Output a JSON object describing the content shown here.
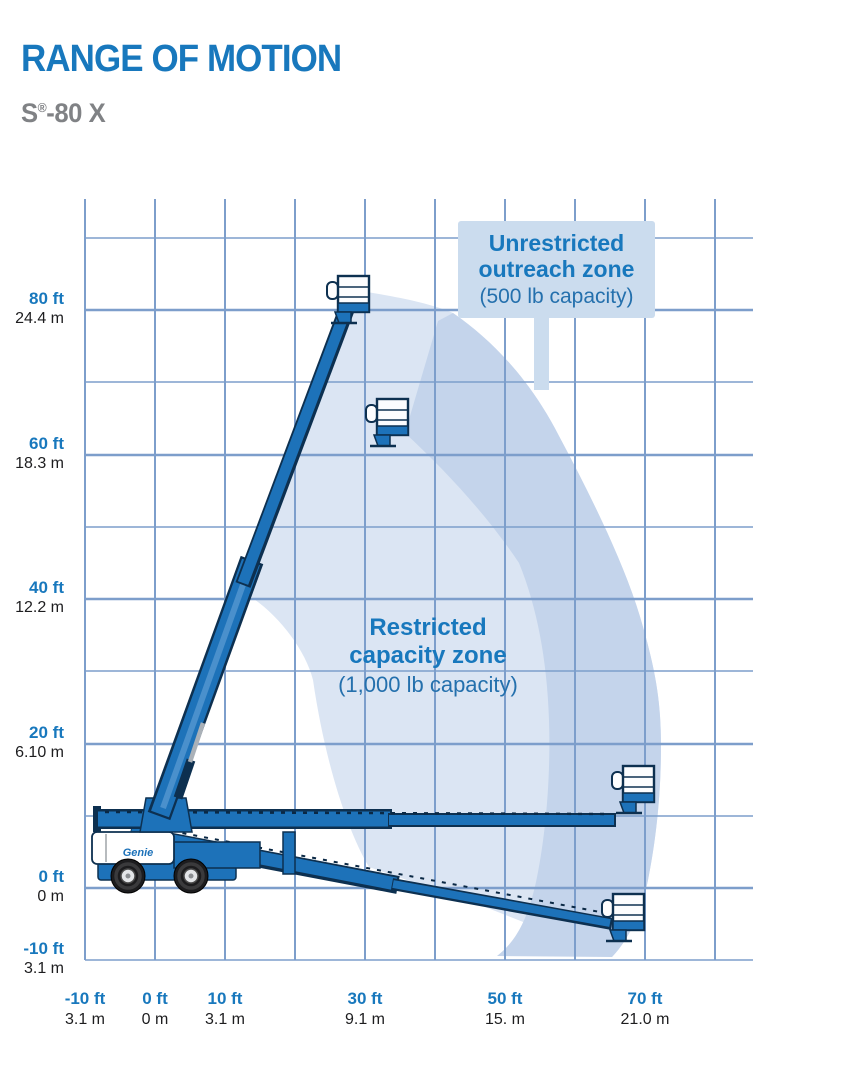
{
  "header": {
    "title": "RANGE OF MOTION",
    "model_prefix": "S",
    "model_reg": "®",
    "model_suffix": "-80 X"
  },
  "colors": {
    "brand_blue": "#1878bd",
    "machine_blue": "#1d72b9",
    "outline_navy": "#0d3050",
    "grid_blue": "#7d9ecb",
    "restricted_zone_fill": "#dbe5f3",
    "unrestricted_zone_fill": "#c4d4eb",
    "label_box_fill": "#cbdcee",
    "model_gray": "#808285"
  },
  "chart": {
    "y_ticks": [
      {
        "ft": "80 ft",
        "m": "24.4 m",
        "y": 310
      },
      {
        "ft": "60 ft",
        "m": "18.3 m",
        "y": 455
      },
      {
        "ft": "40 ft",
        "m": "12.2 m",
        "y": 599
      },
      {
        "ft": "20 ft",
        "m": "6.10 m",
        "y": 744
      },
      {
        "ft": "0 ft",
        "m": "0 m",
        "y": 888
      },
      {
        "ft": "-10 ft",
        "m": "3.1 m",
        "y": 960
      }
    ],
    "x_ticks": [
      {
        "ft": "-10 ft",
        "m": "3.1 m",
        "x": 85
      },
      {
        "ft": "0 ft",
        "m": "0 m",
        "x": 155
      },
      {
        "ft": "10 ft",
        "m": "3.1 m",
        "x": 225
      },
      {
        "ft": "30 ft",
        "m": "9.1 m",
        "x": 365
      },
      {
        "ft": "50 ft",
        "m": "15. m",
        "x": 505
      },
      {
        "ft": "70 ft",
        "m": "21.0 m",
        "x": 645
      }
    ]
  },
  "zones": {
    "unrestricted": {
      "line1": "Unrestricted",
      "line2": "outreach zone",
      "line3": "(500 lb capacity)"
    },
    "restricted": {
      "line1": "Restricted",
      "line2": "capacity zone",
      "line3": "(1,000 lb capacity)"
    }
  },
  "machine": {
    "brand": "Genie"
  }
}
